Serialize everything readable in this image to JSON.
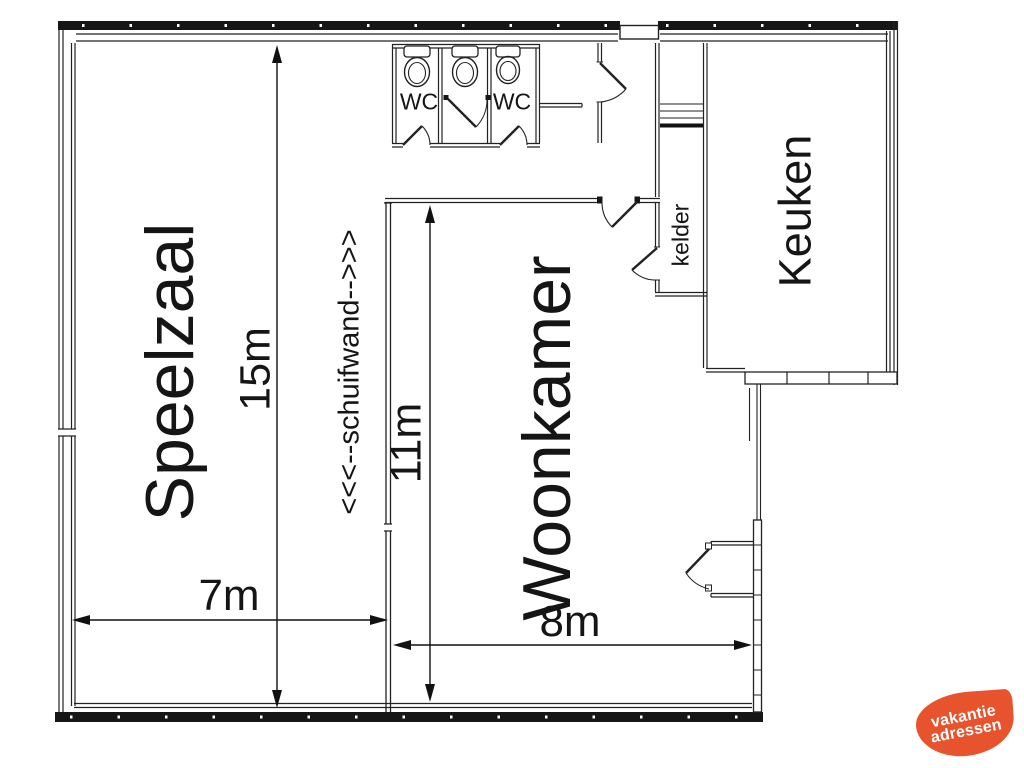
{
  "rooms": {
    "speelzaal": "Speelzaal",
    "woonkamer": "Woonkamer",
    "keuken": "Keuken",
    "kelder": "kelder",
    "wc_left": "WC",
    "wc_right": "WC"
  },
  "dimensions": {
    "speelzaal_height": "15m",
    "woonkamer_height": "11m",
    "speelzaal_width": "7m",
    "woonkamer_width": "8m"
  },
  "annotations": {
    "schuifwand": "<<<--schuifwand-->>>"
  },
  "logo": {
    "line1": "vakantie",
    "line2": "adressen",
    "color": "#e6532c"
  },
  "colors": {
    "wall": "#161616",
    "line": "#222222",
    "text": "#151515"
  }
}
